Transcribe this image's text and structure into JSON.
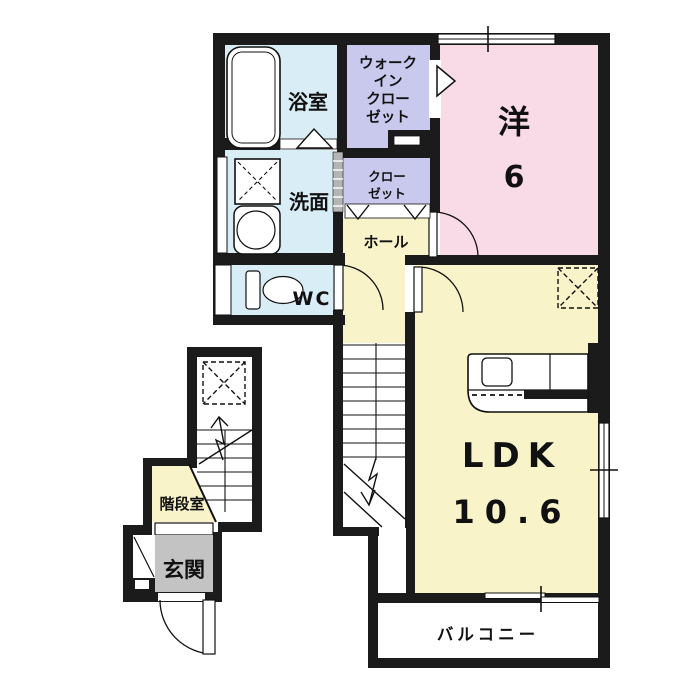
{
  "rooms": {
    "bathroom": {
      "label": "浴室"
    },
    "washroom": {
      "label": "洗面"
    },
    "wc": {
      "label": "WC"
    },
    "walk_in_closet": {
      "line1": "ウォーク",
      "line2": "イン",
      "line3": "クロー",
      "line4": "ゼット"
    },
    "closet": {
      "line1": "クロー",
      "line2": "ゼット"
    },
    "western_room": {
      "name": "洋",
      "size": "6"
    },
    "hall": {
      "label": "ホール"
    },
    "ldk": {
      "name": "LDK",
      "size": "10.6"
    },
    "stair_room": {
      "label": "階段室"
    },
    "entrance": {
      "label": "玄関"
    },
    "balcony": {
      "label": "バルコニー"
    }
  },
  "colors": {
    "wall": "#1b1b1b",
    "wet_area": "#d9edf6",
    "closet_area": "#c9c9ee",
    "bedroom": "#f8dbe7",
    "living": "#f8f3c9",
    "entrance_floor": "#c3c3c3",
    "line": "#111111",
    "background": "#ffffff"
  }
}
